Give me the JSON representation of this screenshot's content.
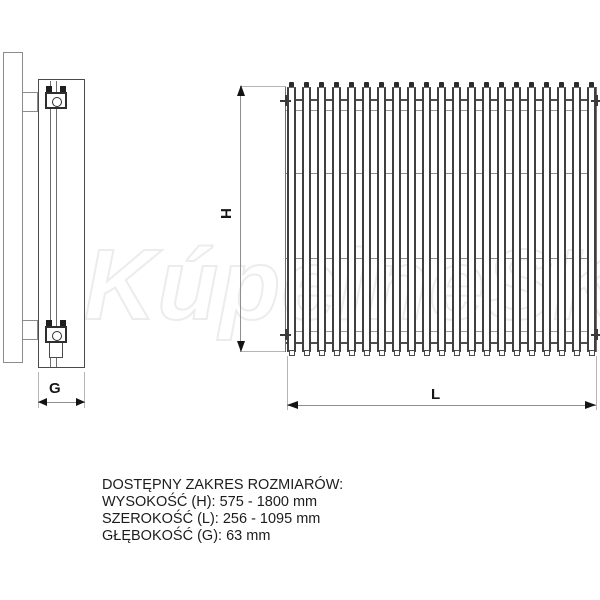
{
  "watermark": "KúpelneSK",
  "diagram": {
    "height_label": "H",
    "width_label": "L",
    "depth_label": "G"
  },
  "specs": {
    "title": "DOSTĘPNY ZAKRES ROZMIARÓW:",
    "lines": [
      "WYSOKOŚĆ (H): 575 - 1800 mm",
      "SZEROKOŚĆ (L): 256 - 1095 mm",
      "GŁĘBOKOŚĆ (G): 63 mm"
    ]
  }
}
